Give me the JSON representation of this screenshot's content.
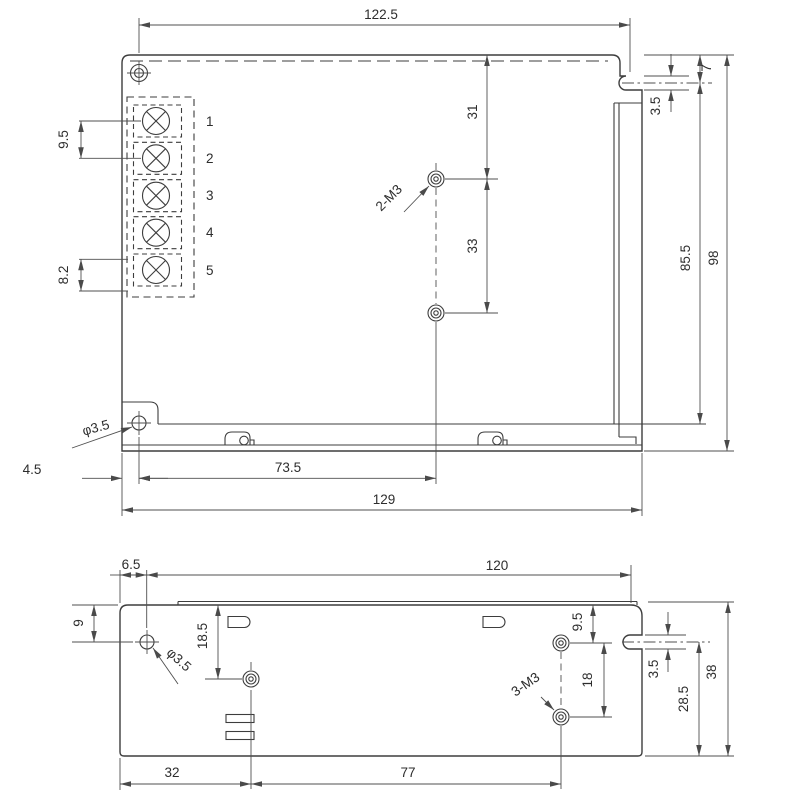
{
  "drawing_title": "enclosure-mechanical-drawing",
  "top_view": {
    "width_mount": "122.5",
    "terminal_pitch": "9.5",
    "terminal_slot": "8.2",
    "hole_offset_top": "31",
    "hole_pitch": "33",
    "holes_label": "2-M3",
    "notch_offset": "7",
    "notch_width": "3.5",
    "mount_height": "85.5",
    "total_height": "98",
    "side_hole_label": "φ3.5",
    "side_hole_offset": "4.5",
    "holes_offset_left": "73.5",
    "total_width": "129",
    "terminals": [
      "1",
      "2",
      "3",
      "4",
      "5"
    ]
  },
  "bottom_view": {
    "hole_offset_left": "6.5",
    "mount_width": "120",
    "hole_offset_top": "9",
    "side_hole_label": "φ3.5",
    "hole1_offset_top": "18.5",
    "right_hole_offset_top": "9.5",
    "right_hole_pitch": "18",
    "holes_label": "3-M3",
    "notch_width": "3.5",
    "notch_to_bottom": "28.5",
    "total_height": "38",
    "hole1_offset_left": "32",
    "holes_span": "77"
  }
}
